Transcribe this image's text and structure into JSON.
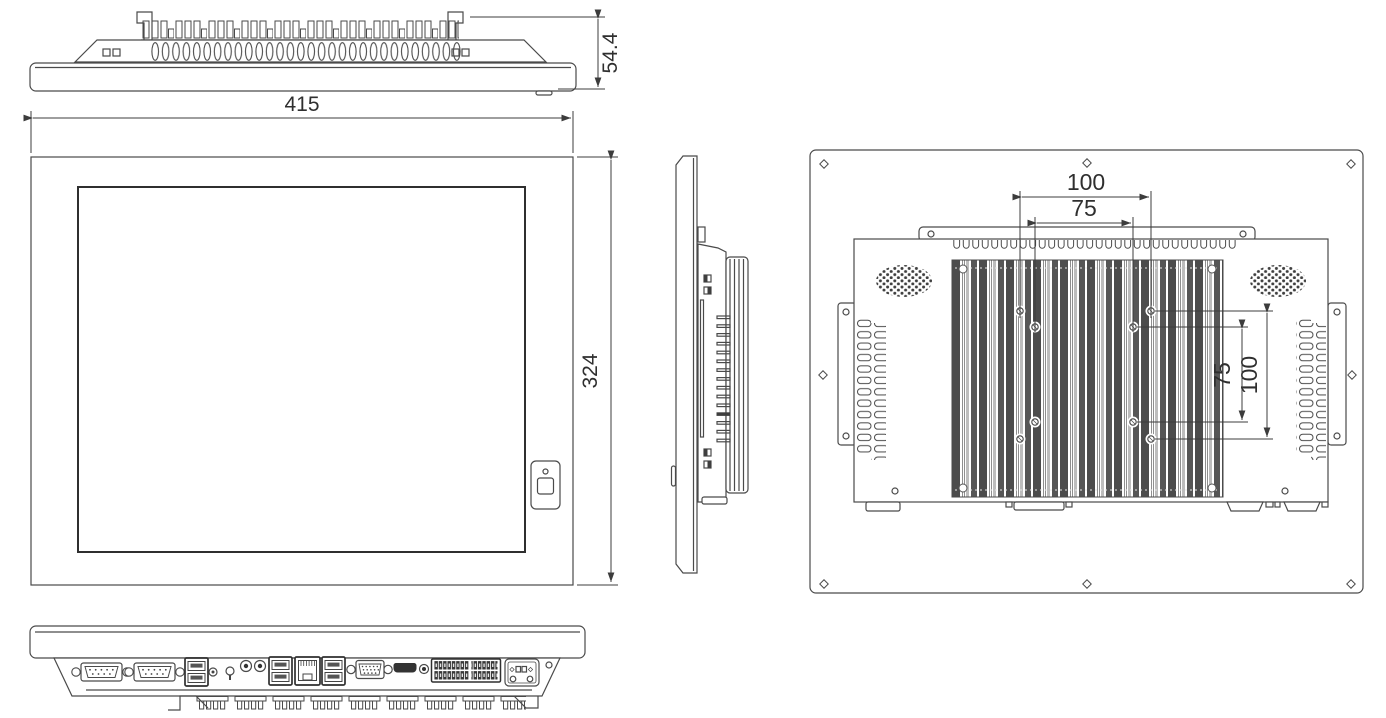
{
  "title": "panel-pc-mechanical-drawing",
  "dimensions": {
    "width": "415",
    "height": "324",
    "depth": "54.4",
    "vesa_top_outer": "100",
    "vesa_top_inner": "75",
    "vesa_side_inner": "75",
    "vesa_side_outer": "100"
  },
  "colors": {
    "background": "#ffffff",
    "line": "#4a4a4a",
    "dimension_line": "#3c3c3c",
    "text": "#2f2f2f",
    "fin_dark": "#4c4c4c",
    "fin_mid": "#8f8f8f",
    "fin_light": "#bdbdbd"
  },
  "ports": [
    "serial-port-1",
    "serial-port-2",
    "usb-dual-port-1",
    "reset-button",
    "ground-stud",
    "audio-jack-1",
    "audio-jack-2",
    "usb-dual-port-2",
    "ethernet-port",
    "usb-dual-port-3",
    "vga-port",
    "hdmi-port",
    "dc-jack",
    "terminal-block",
    "power-input-connector",
    "power-button"
  ]
}
